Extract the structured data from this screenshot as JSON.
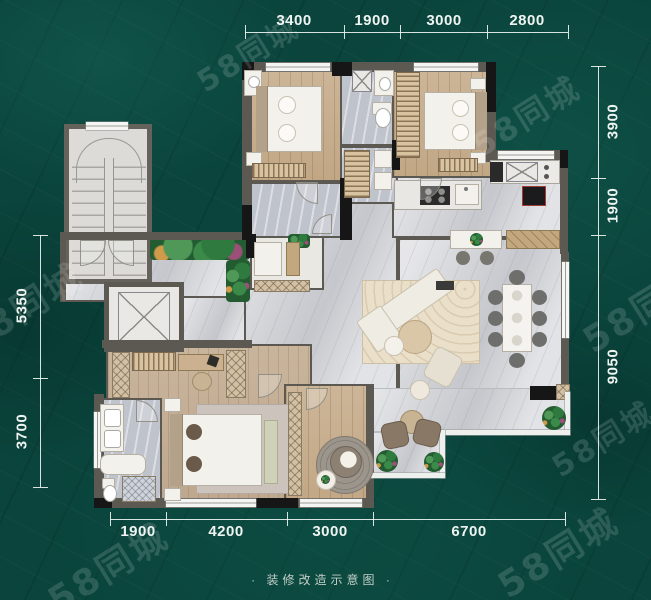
{
  "watermark": {
    "text": "58同城"
  },
  "caption": {
    "text": "· 装修改造示意图 ·"
  },
  "dims": {
    "top": [
      "3400",
      "1900",
      "3000",
      "2800"
    ],
    "right": [
      "3900",
      "1900",
      "9050"
    ],
    "left": [
      "5350",
      "3700"
    ],
    "bottom": [
      "1900",
      "4200",
      "3000",
      "6700"
    ]
  },
  "colors": {
    "background_teal": "#0a443c",
    "dimension_text": "#eef4f1",
    "wall_gray": "#5b5951",
    "column_black": "#161616",
    "marble_floor": "#d6d7db",
    "wood_floor": "#c8ae8f",
    "planter_green": "#2f6b3d",
    "railing_white": "#eef0ee"
  }
}
